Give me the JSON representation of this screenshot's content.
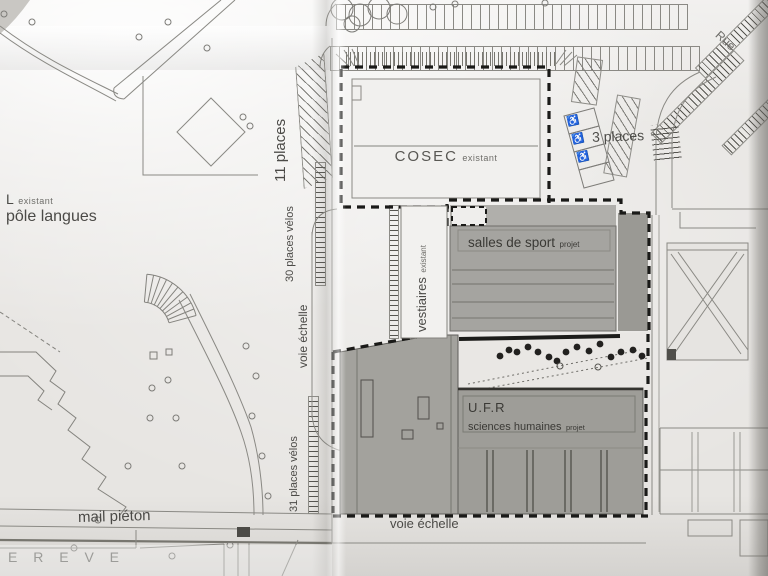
{
  "plan": {
    "streets": {
      "rue": "Rue",
      "mail_pieton": "mail piéton",
      "voie_echelle_vertical": "voie échelle",
      "voie_echelle_bottom": "voie échelle"
    },
    "parking": {
      "places_11": "11 places",
      "places_3": "3 places",
      "velos_30": "30 places vélos",
      "velos_31": "31 places vélos"
    },
    "buildings": {
      "cosec": {
        "name": "COSEC",
        "status": "existant"
      },
      "pole_langues": {
        "prefix": "L",
        "status": "existant",
        "name": "pôle langues"
      },
      "vestiaires": {
        "name": "vestiaires",
        "status": "existant"
      },
      "salles_de_sport": {
        "name": "salles de sport",
        "status": "projet"
      },
      "ufr": {
        "name": "U.F.R",
        "subname": "sciences humaines",
        "status": "projet"
      },
      "breve": {
        "name": "E R E V E"
      }
    },
    "icons": {
      "wheelchair": "♿"
    },
    "colors": {
      "paper": "#e7e5e2",
      "building_gray": "#a3a29d",
      "line_dark": "#1a1a18",
      "line_gray": "#8a8984"
    }
  }
}
